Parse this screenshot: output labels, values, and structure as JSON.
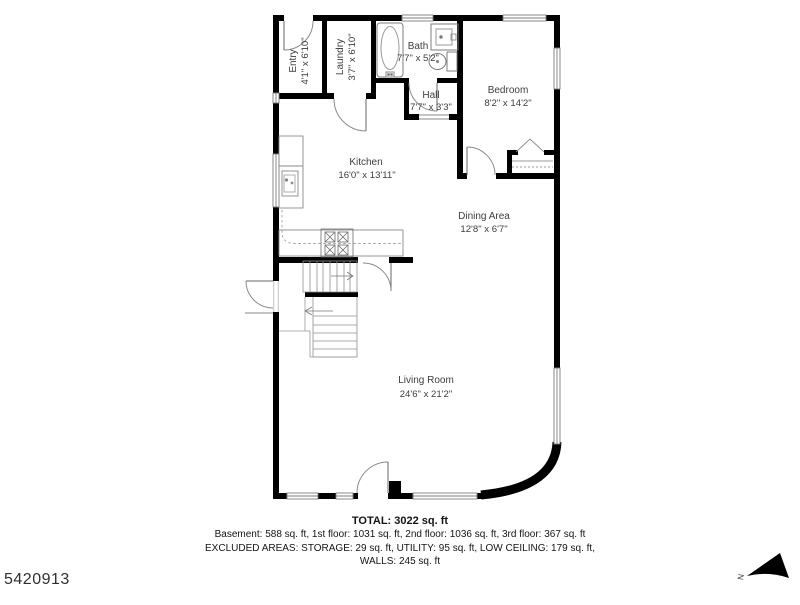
{
  "meta": {
    "listing_id": "5420913"
  },
  "plan": {
    "north_indicator": "N",
    "rooms": [
      {
        "name": "Entry",
        "dims": "4'1\" x 6'10\""
      },
      {
        "name": "Laundry",
        "dims": "3'7\" x 6'10\""
      },
      {
        "name": "Bath",
        "dims": "7'7\" x 5'2\""
      },
      {
        "name": "Hall",
        "dims": "7'7\" x 3'3\""
      },
      {
        "name": "Bedroom",
        "dims": "8'2\" x 14'2\""
      },
      {
        "name": "Kitchen",
        "dims": "16'0\" x 13'11\""
      },
      {
        "name": "Dining Area",
        "dims": "12'8\" x 6'7\""
      },
      {
        "name": "Living Room",
        "dims": "24'6\" x 21'2\""
      }
    ]
  },
  "footer": {
    "total": "TOTAL: 3022 sq. ft",
    "floors": "Basement: 588 sq. ft, 1st floor: 1031 sq. ft, 2nd floor: 1036 sq. ft, 3rd floor: 367 sq. ft",
    "excluded": "EXCLUDED AREAS: STORAGE: 29 sq. ft, UTILITY: 95 sq. ft, LOW CEILING: 179 sq. ft,",
    "walls": "WALLS: 245 sq. ft"
  },
  "colors": {
    "wall": "#000000",
    "fixture_line": "#8a8a8a",
    "label_text": "#3d3d3d"
  }
}
